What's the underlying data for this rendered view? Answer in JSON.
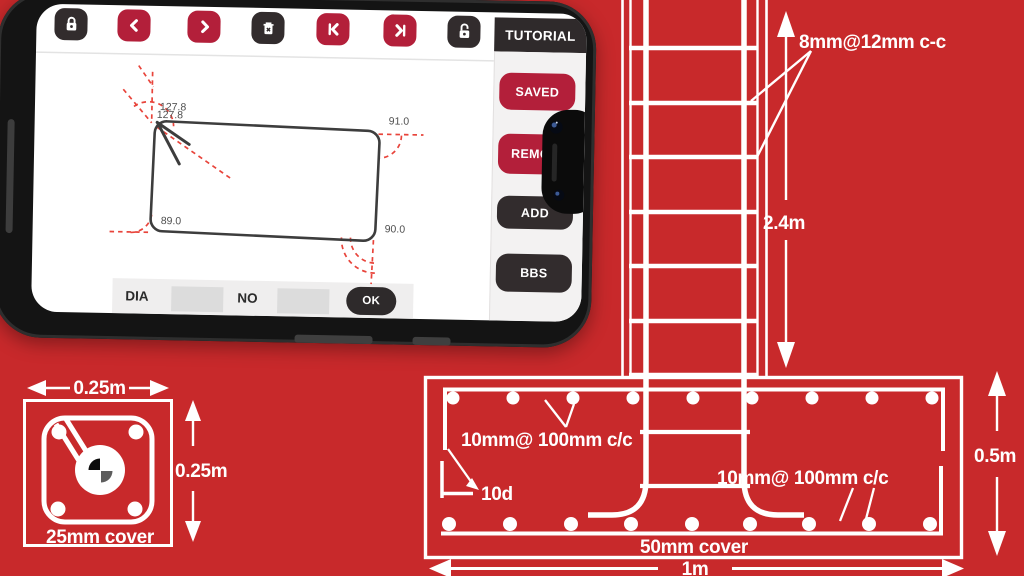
{
  "colors": {
    "background_red": "#c8292b",
    "app_accent_red": "#b31f3a",
    "app_dark": "#322c2d",
    "dashed_guide_red": "#e8443b",
    "diagram_white": "#ffffff"
  },
  "phone": {
    "header": {
      "title": "TUTORIAL"
    },
    "toolbar": {
      "icons": [
        "lock-closed",
        "chevron-left",
        "chevron-right",
        "trash-delete",
        "skip-to-start",
        "skip-to-end",
        "lock-open"
      ]
    },
    "sidebar": {
      "buttons": [
        {
          "label": "SAVED",
          "style": "red"
        },
        {
          "label": "REMO",
          "style": "red"
        },
        {
          "label": "ADD",
          "style": "dark"
        },
        {
          "label": "BBS",
          "style": "dark"
        }
      ]
    },
    "canvas": {
      "angles": {
        "top_left_a": "127.8",
        "top_left_b": "127.8",
        "top_right": "91.0",
        "bottom_left": "89.0",
        "bottom_right": "90.0"
      }
    },
    "bottom_bar": {
      "dia_label": "DIA",
      "dia_value": "",
      "no_label": "NO",
      "no_value": "",
      "ok_label": "OK"
    }
  },
  "diagram": {
    "column": {
      "stirrups_label": "8mm@12mm c-c",
      "height_label": "2.4m"
    },
    "footing": {
      "top_bars_label": "10mm@ 100mm c/c",
      "bottom_bars_label": "10mm@ 100mm c/c",
      "hook_label": "10d",
      "cover_label": "50mm cover",
      "width_label": "1m",
      "depth_label": "0.5m"
    },
    "section": {
      "width_label": "0.25m",
      "height_label": "0.25m",
      "cover_label": "25mm cover"
    }
  }
}
